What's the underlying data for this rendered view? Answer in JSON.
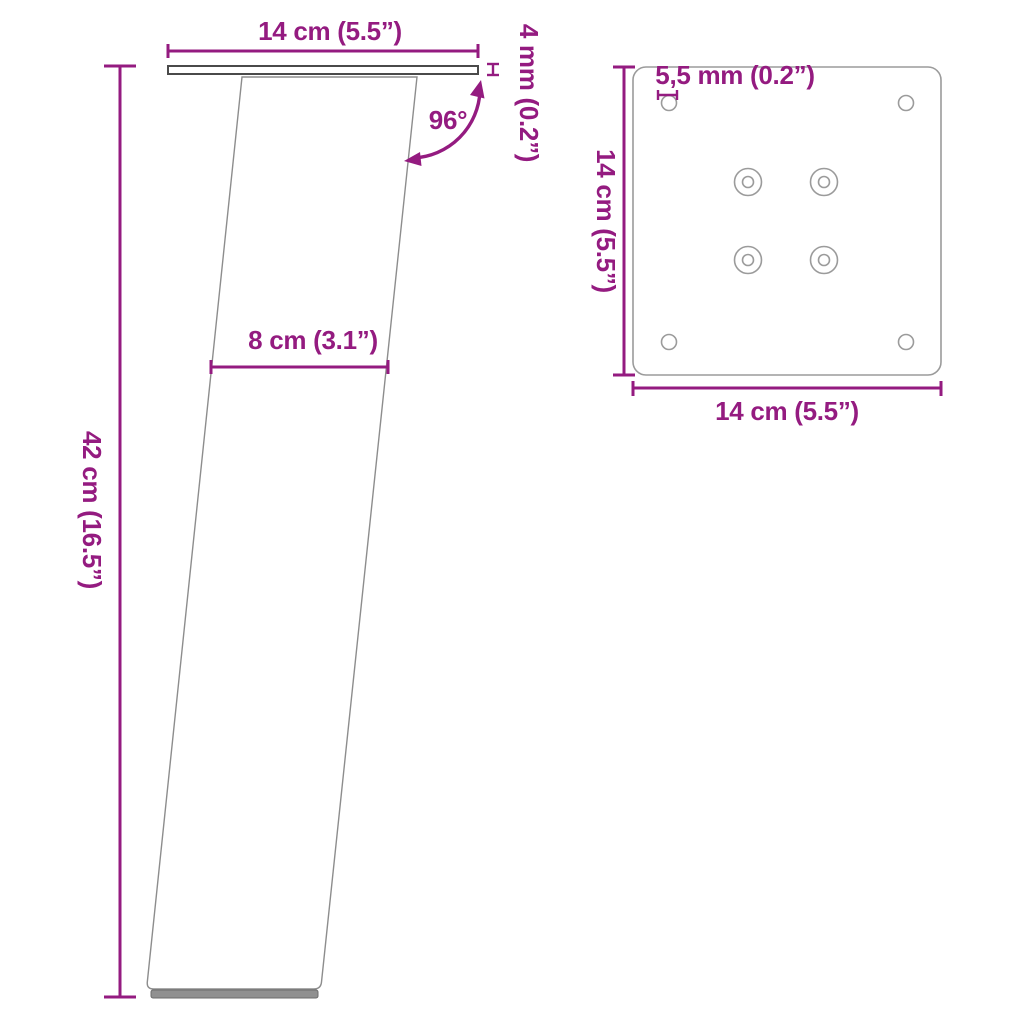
{
  "colors": {
    "accent": "#941b80",
    "outline_dark": "#4a4a4a",
    "outline_light": "#9b9b9b",
    "foot_pad": "#909090"
  },
  "side_view": {
    "top_width": "14 cm (5.5”)",
    "plate_thickness": "4 mm (0.2”)",
    "angle": "96°",
    "leg_width": "8 cm (3.1”)",
    "height": "42 cm (16.5”)"
  },
  "top_view": {
    "hole_diameter": "5,5 mm (0.2”)",
    "side_length": "14 cm (5.5”)",
    "bottom_length": "14 cm (5.5”)"
  }
}
